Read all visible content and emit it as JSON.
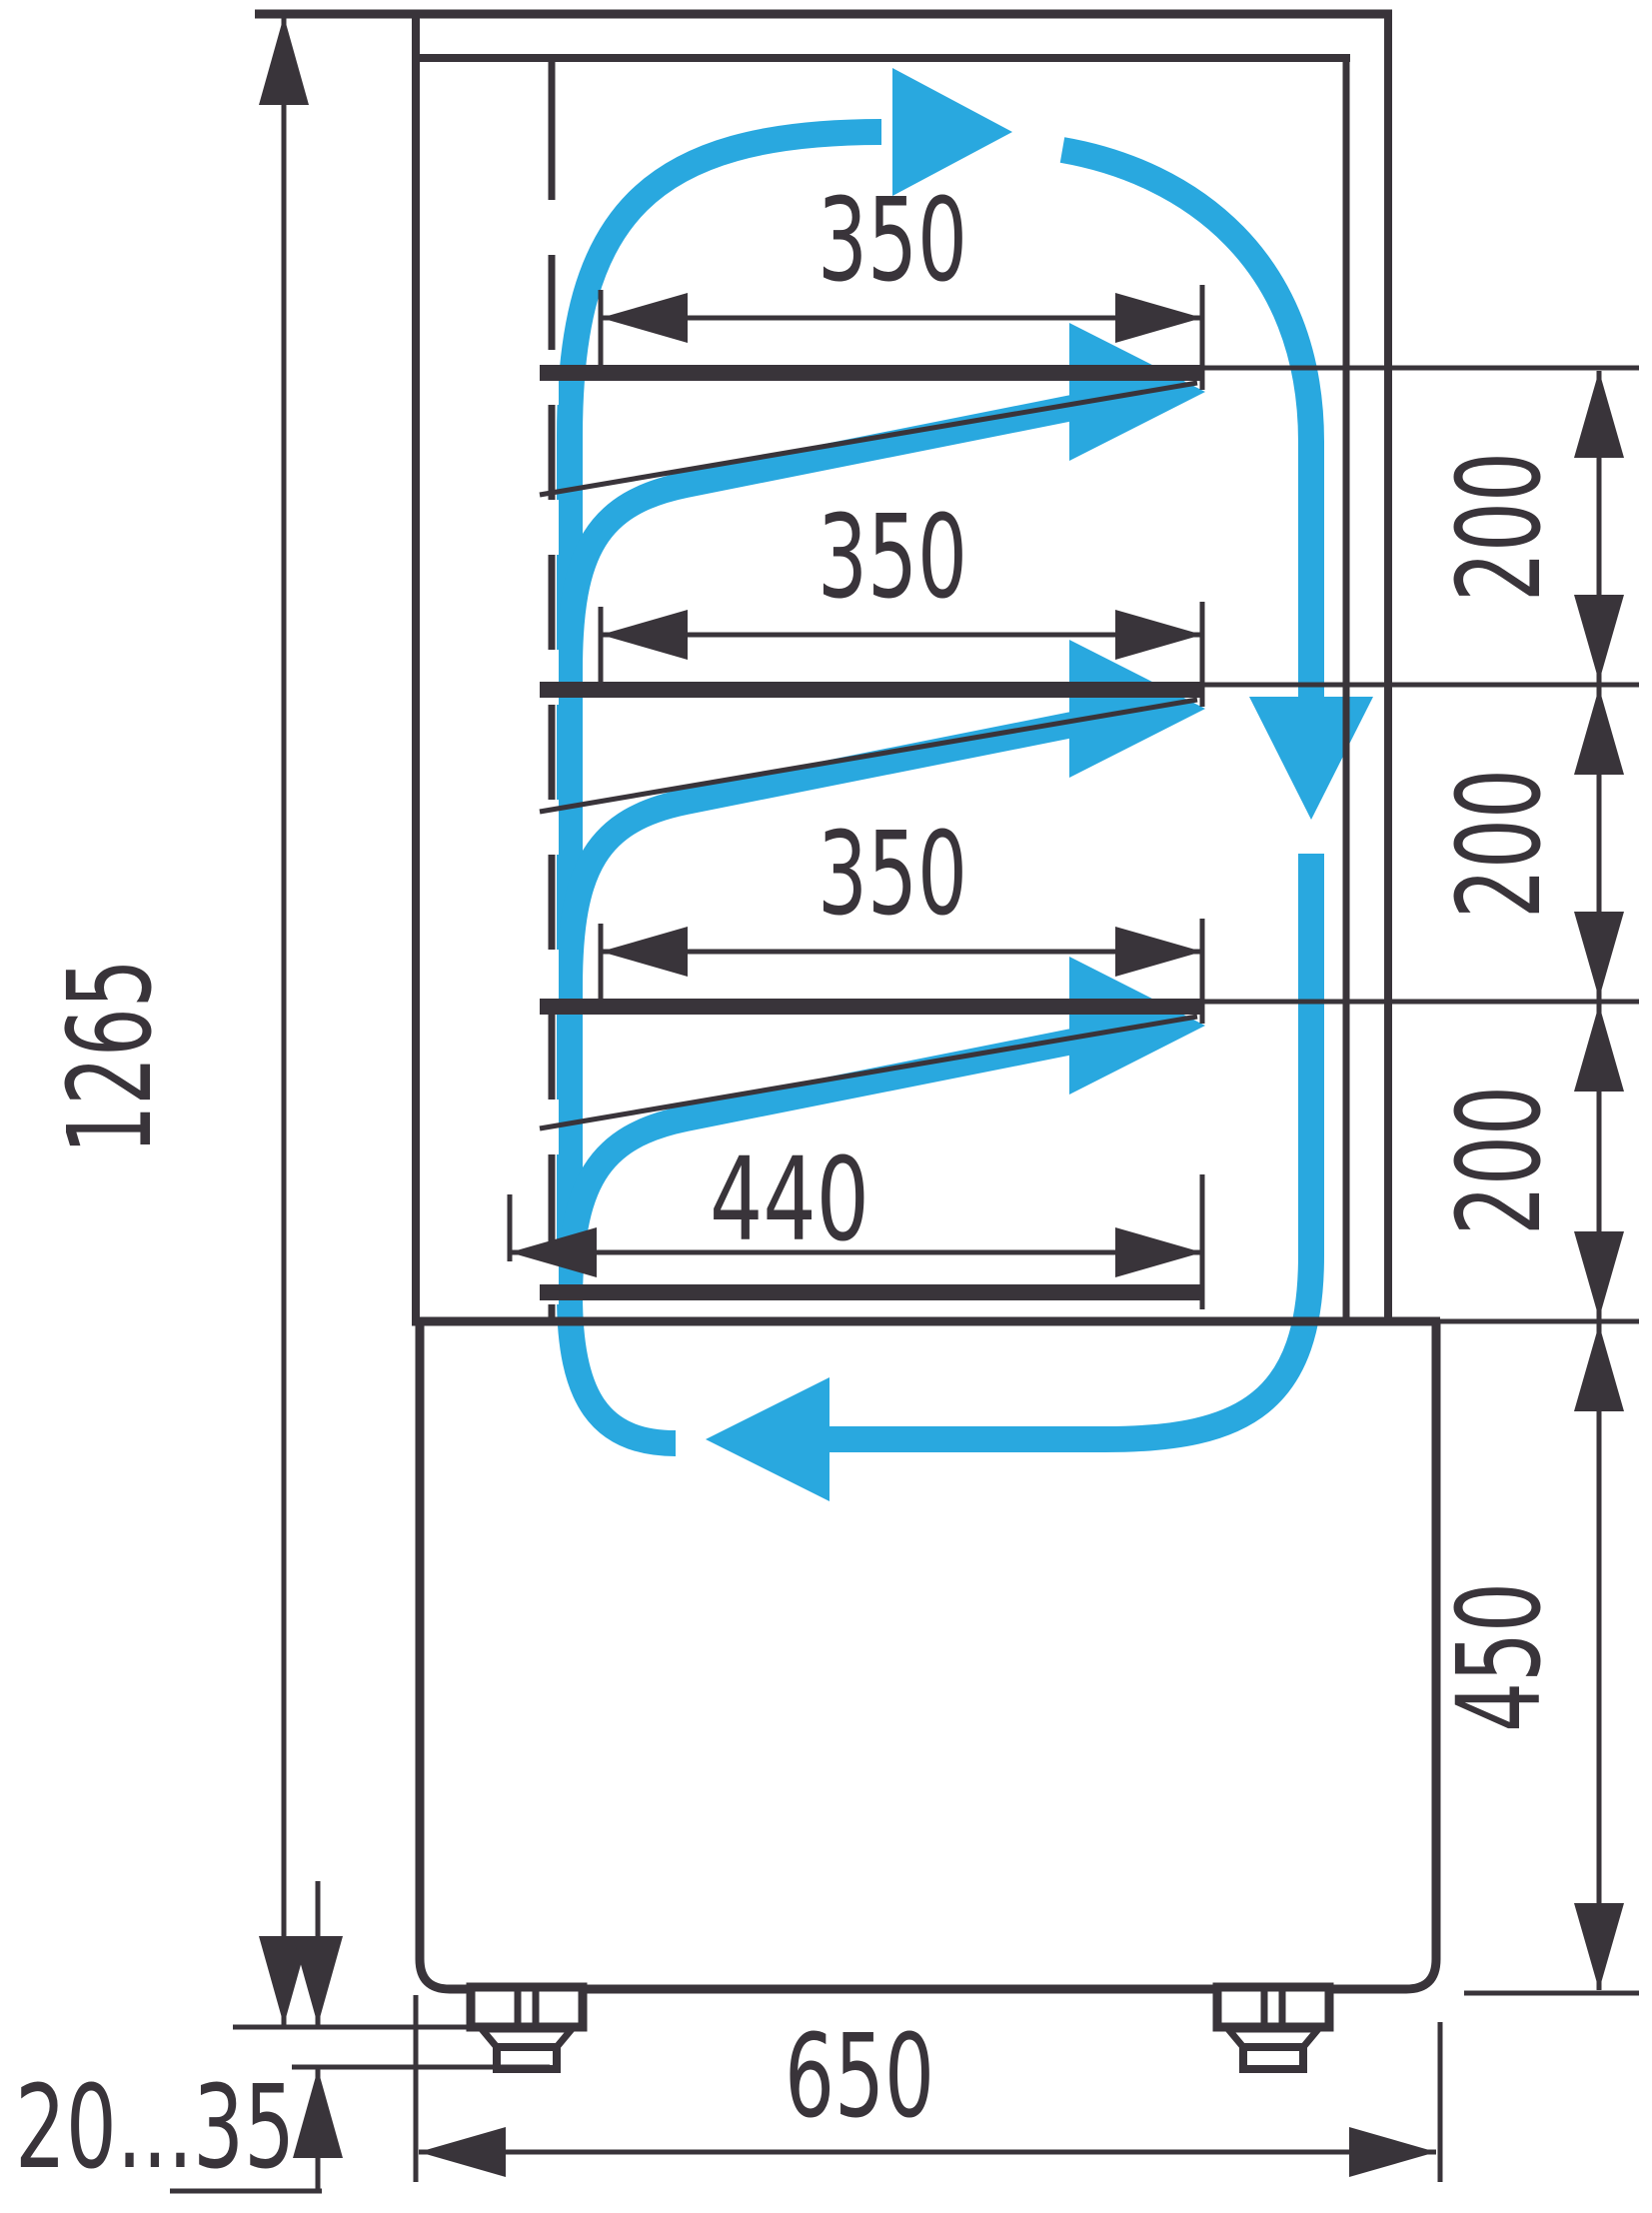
{
  "drawing": {
    "type": "technical-dimension-drawing",
    "subject": "refrigerated display case side section with airflow",
    "colors": {
      "line": "#39343a",
      "airflow": "#29a8df",
      "background": "#ffffff"
    },
    "dimensions": {
      "overall_height": {
        "label": "1265",
        "orientation": "vertical-left"
      },
      "shelf_depth_1": {
        "label": "350",
        "orientation": "horizontal"
      },
      "shelf_depth_2": {
        "label": "350",
        "orientation": "horizontal"
      },
      "shelf_depth_3": {
        "label": "350",
        "orientation": "horizontal"
      },
      "bottom_deck_depth": {
        "label": "440",
        "orientation": "horizontal"
      },
      "shelf_spacing_1": {
        "label": "200",
        "orientation": "vertical-right"
      },
      "shelf_spacing_2": {
        "label": "200",
        "orientation": "vertical-right"
      },
      "shelf_spacing_3": {
        "label": "200",
        "orientation": "vertical-right"
      },
      "base_height": {
        "label": "450",
        "orientation": "vertical-right"
      },
      "base_depth": {
        "label": "650",
        "orientation": "horizontal-bottom"
      },
      "foot_adjustment_range": {
        "label": "20...35",
        "orientation": "horizontal-bottom-left"
      }
    }
  }
}
